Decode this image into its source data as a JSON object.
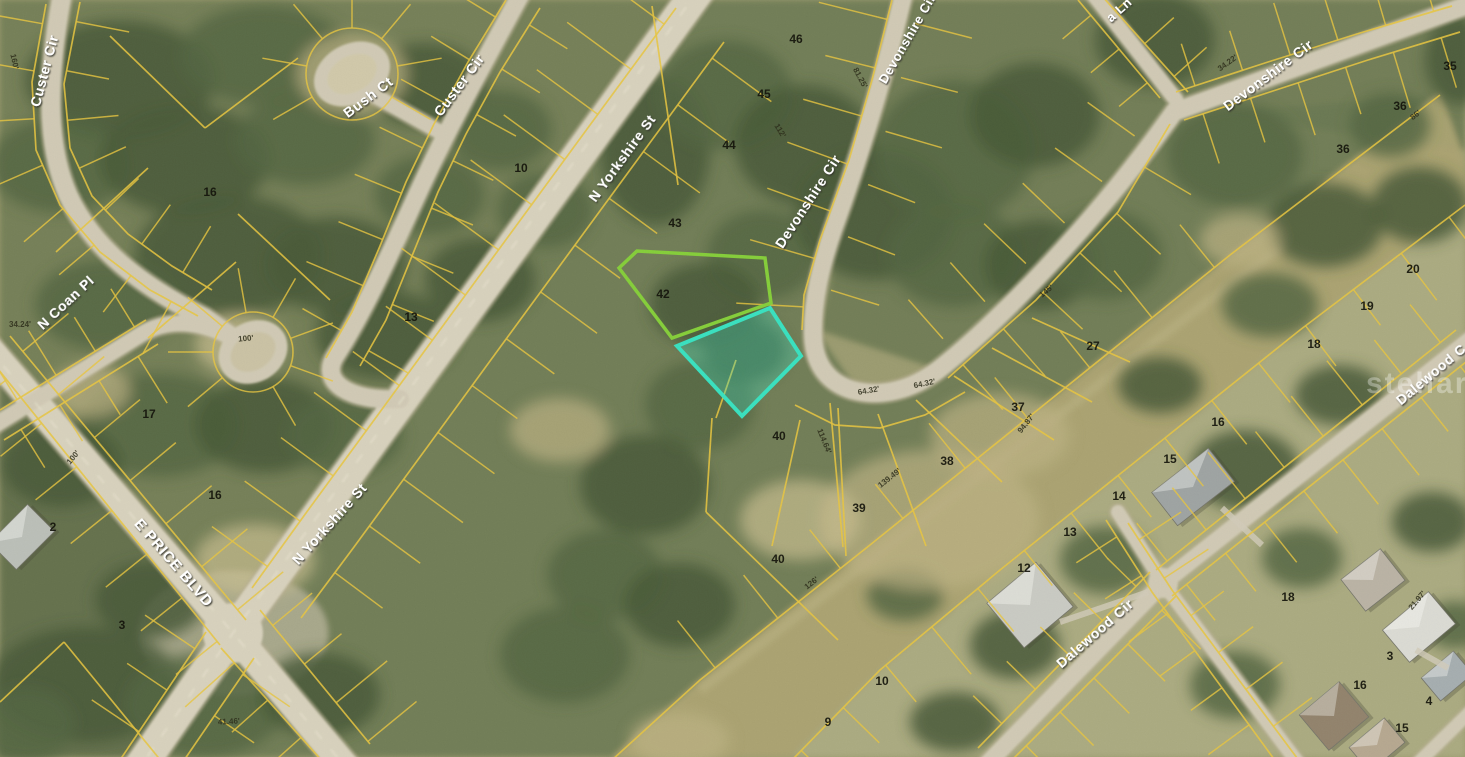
{
  "map": {
    "description": "Aerial parcel map with cadastral lot overlay and highlighted vacant lot",
    "watermark": "stellar MLS",
    "parcel_line_color": "#E8C33B",
    "selected_parcel": {
      "outline_color": "#2FE0C0",
      "fill_color": "rgba(53,223,192,0.33)"
    },
    "adjacent_parcel": {
      "outline_color": "#7FCC33"
    },
    "streets": [
      {
        "name": "Custer Cir"
      },
      {
        "name": "Bush Ct"
      },
      {
        "name": "Custer Cir"
      },
      {
        "name": "N Yorkshire St"
      },
      {
        "name": "N Yorkshire St"
      },
      {
        "name": "E PRICE BLVD"
      },
      {
        "name": "N Coan Pl"
      },
      {
        "name": "Devonshire Cir"
      },
      {
        "name": "Devonshire Cir"
      },
      {
        "name": "Devonshire Cir"
      },
      {
        "name": "a Ln"
      },
      {
        "name": "Dalewood Cir"
      },
      {
        "name": "Dalewood C"
      }
    ],
    "lots": [
      {
        "n": "16"
      },
      {
        "n": "13"
      },
      {
        "n": "10"
      },
      {
        "n": "17"
      },
      {
        "n": "16"
      },
      {
        "n": "2"
      },
      {
        "n": "3"
      },
      {
        "n": "46"
      },
      {
        "n": "45"
      },
      {
        "n": "44"
      },
      {
        "n": "43"
      },
      {
        "n": "42"
      },
      {
        "n": "40"
      },
      {
        "n": "40"
      },
      {
        "n": "39"
      },
      {
        "n": "38"
      },
      {
        "n": "37"
      },
      {
        "n": "27"
      },
      {
        "n": "35"
      },
      {
        "n": "36"
      },
      {
        "n": "36"
      },
      {
        "n": "20"
      },
      {
        "n": "19"
      },
      {
        "n": "18"
      },
      {
        "n": "16"
      },
      {
        "n": "15"
      },
      {
        "n": "14"
      },
      {
        "n": "13"
      },
      {
        "n": "12"
      },
      {
        "n": "18"
      },
      {
        "n": "3"
      },
      {
        "n": "16"
      },
      {
        "n": "4"
      },
      {
        "n": "15"
      },
      {
        "n": "10"
      },
      {
        "n": "9"
      }
    ],
    "dimensions": [
      {
        "t": "100'"
      },
      {
        "t": "34.24'"
      },
      {
        "t": "41.46'"
      },
      {
        "t": "64.32'"
      },
      {
        "t": "64.32'"
      },
      {
        "t": "126'"
      },
      {
        "t": "114.64'"
      },
      {
        "t": "139.49'"
      },
      {
        "t": "94.87'"
      },
      {
        "t": "34.22'"
      },
      {
        "t": "21.97'"
      },
      {
        "t": "145'"
      },
      {
        "t": "86'"
      },
      {
        "t": "81.25'"
      },
      {
        "t": "112'"
      },
      {
        "t": "160'"
      },
      {
        "t": "100'"
      }
    ]
  }
}
